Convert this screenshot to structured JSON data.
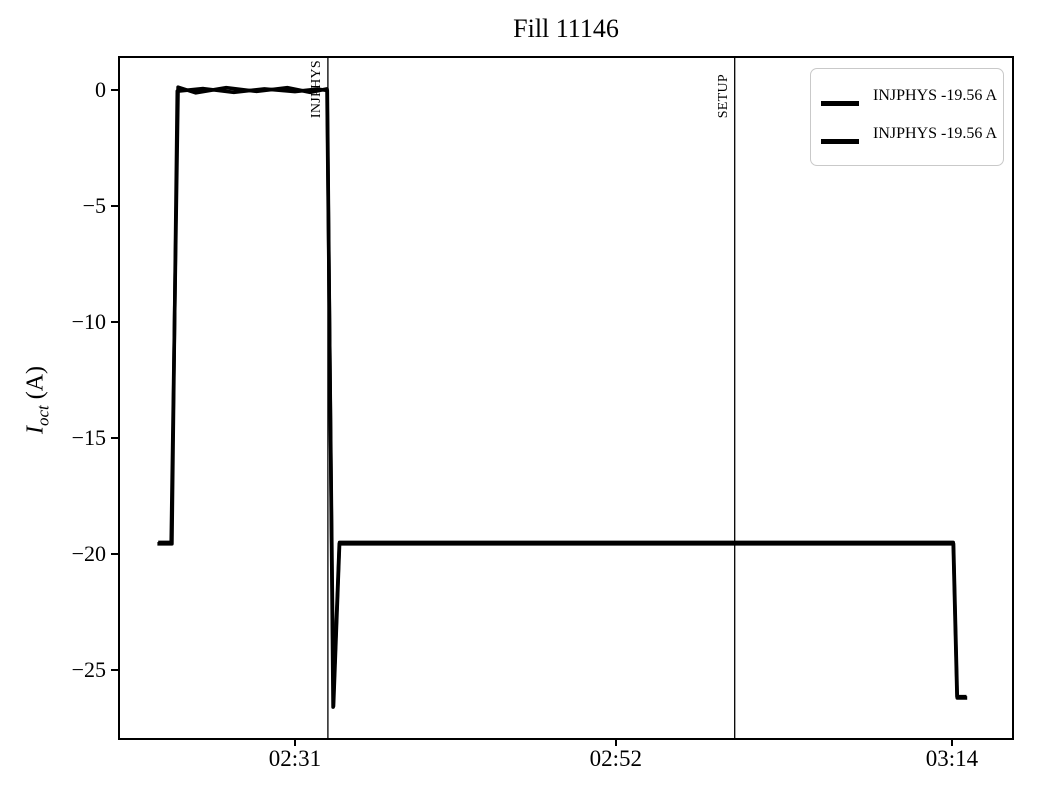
{
  "chart_data": {
    "type": "line",
    "title": "Fill 11146",
    "ylabel_parts": {
      "var": "I",
      "sub": "oct",
      "unit": " (A)"
    },
    "axis_color": "#000000",
    "xlim_minutes": [
      139.55,
      197.93
    ],
    "ylim": [
      -27.93,
      1.38
    ],
    "xticks": [
      {
        "minute": 151,
        "label": "02:31"
      },
      {
        "minute": 172,
        "label": "02:52"
      },
      {
        "minute": 194,
        "label": "03:14"
      }
    ],
    "yticks": [
      {
        "value": 0,
        "label": "0"
      },
      {
        "value": -5,
        "label": "−5"
      },
      {
        "value": -10,
        "label": "−10"
      },
      {
        "value": -15,
        "label": "−15"
      },
      {
        "value": -20,
        "label": "−20"
      },
      {
        "value": -25,
        "label": "−25"
      }
    ],
    "events": [
      {
        "label": "INJPHYS",
        "minute": 153.16
      },
      {
        "label": "SETUP",
        "minute": 179.78
      }
    ],
    "grid": false,
    "legend_position": "upper right",
    "series": [
      {
        "name": "INJPHYS -19.56 A",
        "color": "#000000",
        "line_width": 3.6,
        "points": [
          [
            142.0,
            -19.56
          ],
          [
            142.95,
            -19.56
          ],
          [
            143.3,
            -0.05
          ],
          [
            145.0,
            0.06
          ],
          [
            147.0,
            -0.1
          ],
          [
            149.0,
            0.05
          ],
          [
            151.0,
            -0.07
          ],
          [
            152.5,
            0.04
          ],
          [
            153.12,
            -0.02
          ],
          [
            153.5,
            -26.6
          ],
          [
            153.9,
            -19.56
          ],
          [
            194.1,
            -19.56
          ],
          [
            194.35,
            -26.2
          ],
          [
            195.0,
            -26.2
          ]
        ]
      },
      {
        "name": "INJPHYS -19.56 A",
        "color": "#000000",
        "line_width": 3.6,
        "points": [
          [
            142.05,
            -19.5
          ],
          [
            142.9,
            -19.5
          ],
          [
            143.35,
            0.12
          ],
          [
            144.5,
            -0.12
          ],
          [
            146.5,
            0.1
          ],
          [
            148.5,
            -0.06
          ],
          [
            150.5,
            0.1
          ],
          [
            152.0,
            -0.1
          ],
          [
            153.1,
            0.05
          ],
          [
            153.52,
            -26.55
          ],
          [
            153.92,
            -19.5
          ],
          [
            194.08,
            -19.5
          ],
          [
            194.33,
            -26.15
          ],
          [
            194.95,
            -26.15
          ]
        ]
      }
    ]
  }
}
